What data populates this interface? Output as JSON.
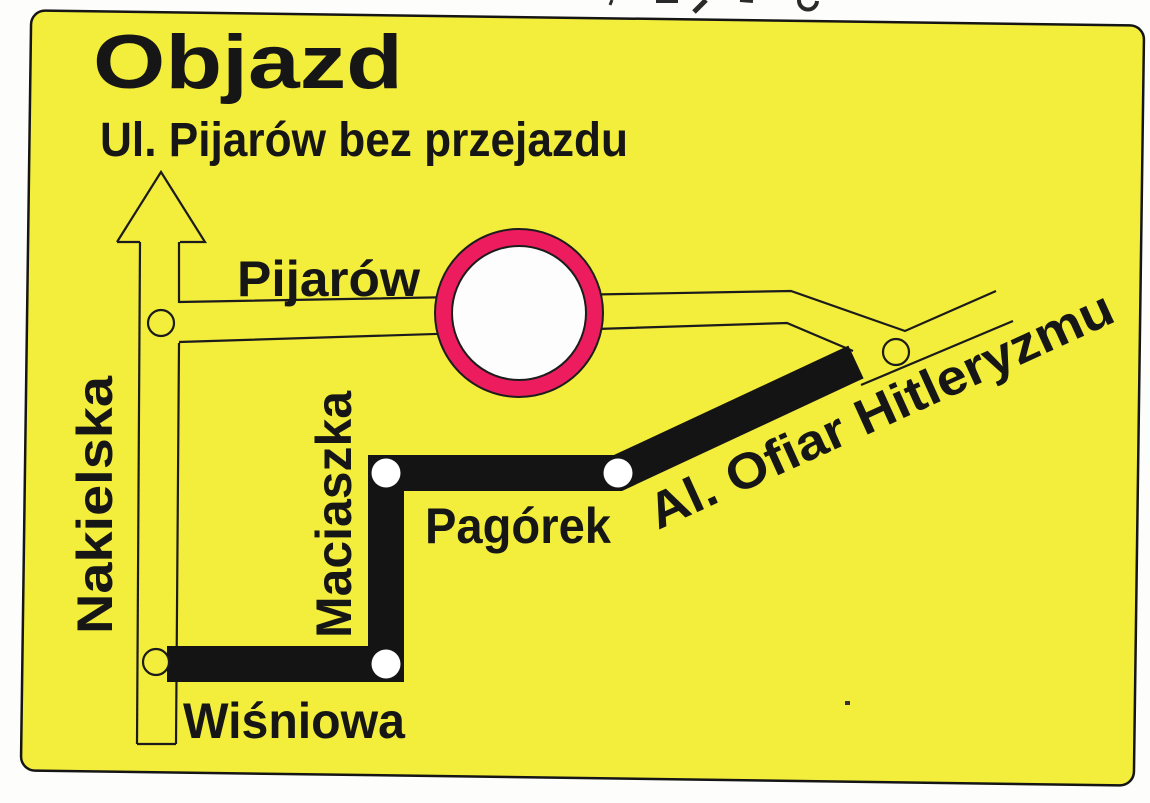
{
  "card": {
    "title": "Objazd",
    "subtitle": "Ul. Pijarów bez przejazdu"
  },
  "streets": {
    "pijarow": "Pijarów",
    "nakielska": "Nakielska",
    "maciaszka": "Maciaszka",
    "pagorek": "Pagórek",
    "wisniowa": "Wiśniowa",
    "al_ofiar": "Al. Ofiar Hitleryzmu"
  },
  "colors": {
    "card_yellow": "#f3ed3c",
    "ink_black": "#161616",
    "detour_route_black": "#141414",
    "sign_ring_red": "#ec1c5f",
    "sign_center_white": "#fdfdfd"
  }
}
